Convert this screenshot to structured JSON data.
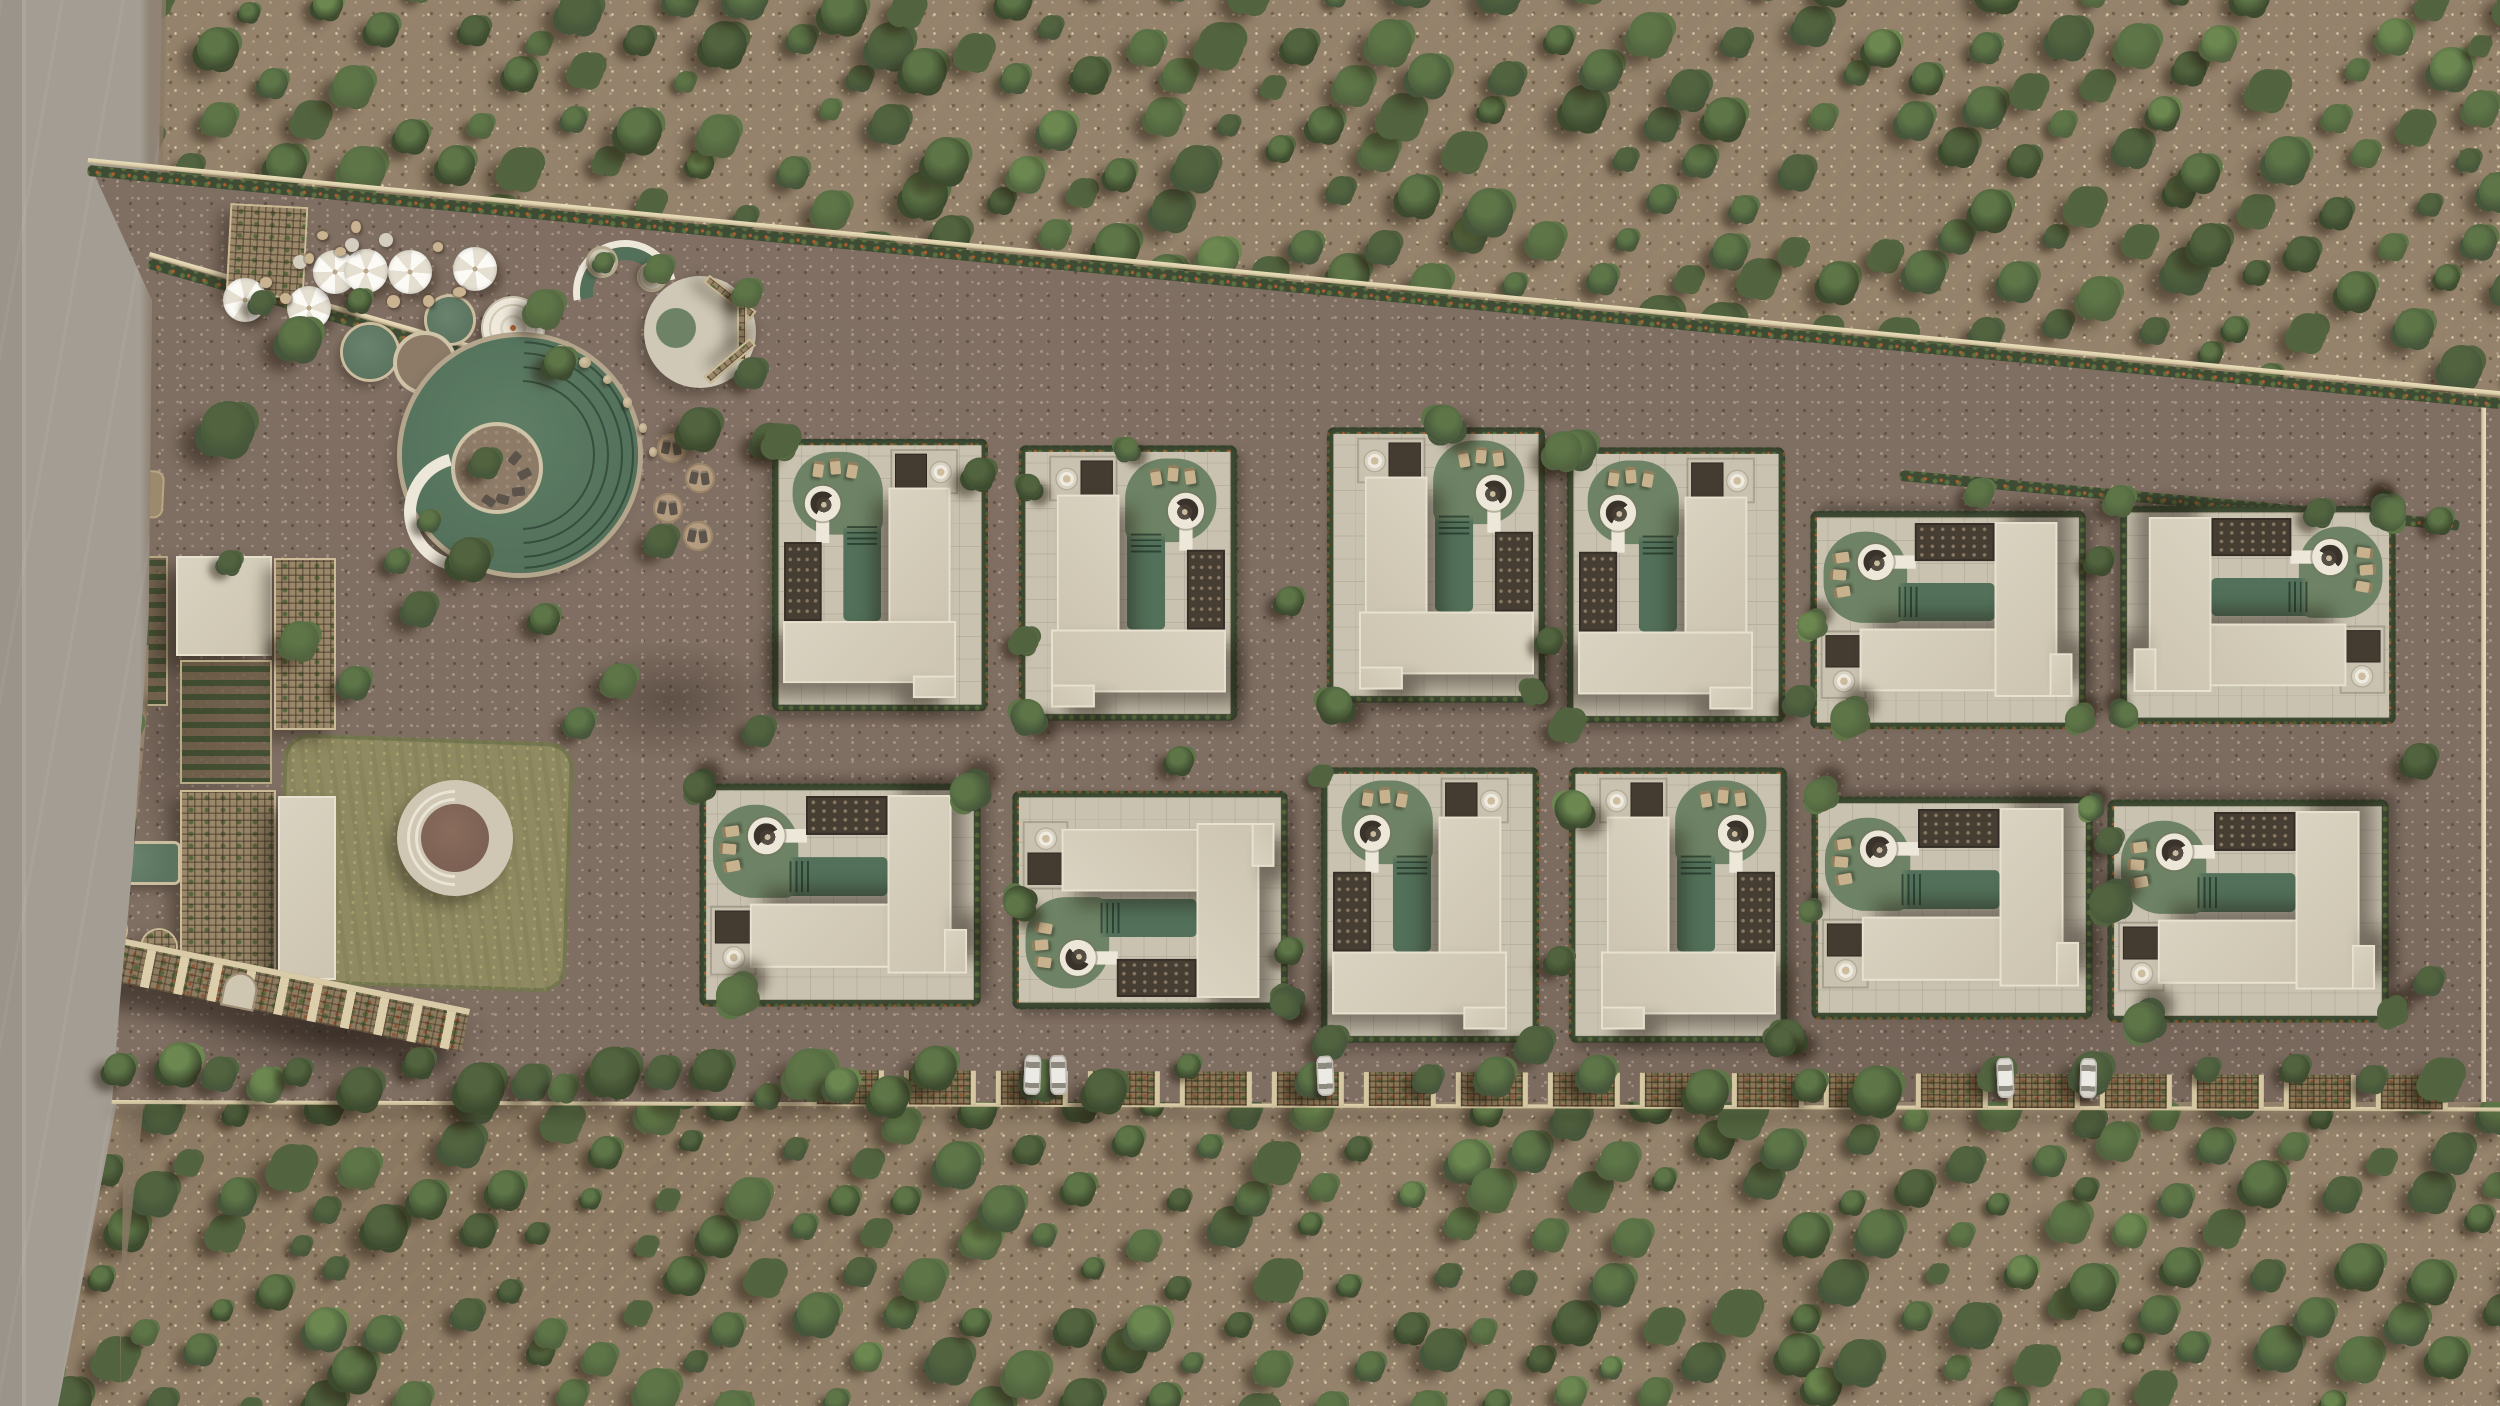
{
  "scene": {
    "type": "architectural-aerial-site-plan",
    "description": "Top-down photorealistic render of a boutique villa resort with amenity gardens set inside an olive grove, access road on the west, parking pergola fence on the south",
    "palette": {
      "road": "#a39d93",
      "roadEdge": "#8b7b66",
      "soil": "#94826c",
      "paving": "#7f6e62",
      "wall": "#dccfab",
      "fence": "#c9ba96",
      "hedge": "#3f4c34",
      "flower": "#b25c2d",
      "villaPave": "#c9c2b0",
      "roof": "#dad3c1",
      "roofEdge": "#e8e1cf",
      "lawn": "#6e8365",
      "pool": "#53715a",
      "deck": "#ece7d9",
      "court": "#473e33",
      "lawnOlive": "#8f8a62",
      "pond": "#5a7460"
    },
    "treePalette": [
      "#3c4a2e",
      "#46563a",
      "#52643f",
      "#5d7547",
      "#6c8850"
    ],
    "grove": {
      "row_angle_deg": -50,
      "row_spacing": 64,
      "tree_spacing": 54,
      "jitter": 14,
      "seed": 7
    },
    "boundary": {
      "north_from": [
        88,
        160
      ],
      "north_to": [
        2500,
        393
      ],
      "south_y": 1102,
      "east_wall_x": 2486
    },
    "villas": {
      "count": 12,
      "rows": 2,
      "instances": [
        {
          "id": "T1",
          "cx": 880,
          "cy": 575,
          "s": 0.94,
          "t": ""
        },
        {
          "id": "T2",
          "cx": 1128,
          "cy": 583,
          "s": 0.95,
          "t": "scaleX(-1)"
        },
        {
          "id": "T3",
          "cx": 1436,
          "cy": 565,
          "s": 0.95,
          "t": "scaleX(-1)"
        },
        {
          "id": "T4",
          "cx": 1676,
          "cy": 585,
          "s": 0.95,
          "t": ""
        },
        {
          "id": "T5",
          "cx": 1948,
          "cy": 620,
          "s": 0.95,
          "t": "rotate(90deg) scaleY(-1)"
        },
        {
          "id": "T6",
          "cx": 2258,
          "cy": 615,
          "s": 0.95,
          "t": "rotate(90deg)"
        },
        {
          "id": "B1",
          "cx": 840,
          "cy": 895,
          "s": 0.97,
          "t": "rotate(90deg) scaleY(-1)"
        },
        {
          "id": "B2",
          "cx": 1150,
          "cy": 900,
          "s": 0.95,
          "t": "rotate(-90deg)"
        },
        {
          "id": "B3",
          "cx": 1430,
          "cy": 905,
          "s": 0.95,
          "t": ""
        },
        {
          "id": "B4",
          "cx": 1678,
          "cy": 905,
          "s": 0.95,
          "t": "scaleX(-1)"
        },
        {
          "id": "B5",
          "cx": 1952,
          "cy": 908,
          "s": 0.97,
          "t": "rotate(90deg) scaleY(-1)"
        },
        {
          "id": "B6",
          "cx": 2248,
          "cy": 911,
          "s": 0.97,
          "t": "rotate(90deg) scaleY(-1)"
        }
      ]
    },
    "fence": {
      "x": 112,
      "y": 1040,
      "w": 2390,
      "bay_step": 92,
      "bays_from": 700,
      "seed": 11
    },
    "cars": [
      {
        "x": 1032
      },
      {
        "x": 1058
      },
      {
        "x": 1325
      },
      {
        "x": 2005
      },
      {
        "x": 2088
      }
    ],
    "umbrellas": [
      [
        245,
        300
      ],
      [
        309,
        308
      ],
      [
        335,
        272
      ],
      [
        366,
        271
      ],
      [
        410,
        272
      ],
      [
        475,
        269
      ]
    ],
    "parasols": [
      [
        352,
        245
      ],
      [
        300,
        262
      ],
      [
        386,
        240
      ]
    ],
    "seats": [
      [
        285,
        298
      ],
      [
        340,
        252
      ],
      [
        392,
        300
      ],
      [
        438,
        247
      ],
      [
        310,
        258
      ],
      [
        356,
        226
      ],
      [
        428,
        300
      ],
      [
        458,
        292
      ],
      [
        265,
        282
      ],
      [
        322,
        236
      ]
    ],
    "loungerPads": [
      [
        672,
        448
      ],
      [
        700,
        478
      ],
      [
        668,
        508
      ],
      [
        698,
        536
      ]
    ],
    "rocks": [
      [
        560,
        350
      ],
      [
        584,
        362
      ],
      [
        608,
        380
      ],
      [
        628,
        402
      ],
      [
        644,
        428
      ],
      [
        654,
        452
      ]
    ],
    "islandLoungers": [
      [
        14,
        -18,
        40
      ],
      [
        24,
        -2,
        62
      ],
      [
        18,
        16,
        84
      ],
      [
        2,
        24,
        104
      ],
      [
        -12,
        26,
        124
      ]
    ],
    "amenityTrees": [
      [
        228,
        428,
        44
      ],
      [
        300,
        338,
        36
      ],
      [
        262,
        302,
        20
      ],
      [
        360,
        300,
        20
      ],
      [
        545,
        308,
        30
      ],
      [
        560,
        362,
        26
      ],
      [
        660,
        268,
        22
      ],
      [
        604,
        262,
        16
      ],
      [
        748,
        292,
        22
      ],
      [
        752,
        372,
        24
      ],
      [
        700,
        428,
        34
      ],
      [
        662,
        540,
        26
      ],
      [
        470,
        558,
        34
      ],
      [
        420,
        608,
        28
      ],
      [
        545,
        618,
        24
      ],
      [
        486,
        462,
        24
      ],
      [
        300,
        640,
        30
      ],
      [
        355,
        682,
        26
      ],
      [
        95,
        302,
        28
      ],
      [
        86,
        382,
        22
      ],
      [
        620,
        680,
        28
      ],
      [
        580,
        722,
        24
      ],
      [
        230,
        562,
        20
      ],
      [
        398,
        560,
        20
      ],
      [
        430,
        520,
        18
      ]
    ],
    "pavingTrees": [
      [
        1290,
        600,
        20
      ],
      [
        1550,
        640,
        18
      ],
      [
        1800,
        700,
        22
      ],
      [
        2100,
        560,
        20
      ],
      [
        1290,
        950,
        18
      ],
      [
        1560,
        960,
        20
      ],
      [
        2110,
        840,
        18
      ],
      [
        1025,
        640,
        20
      ],
      [
        760,
        730,
        22
      ],
      [
        1180,
        760,
        20
      ],
      [
        2420,
        760,
        24
      ],
      [
        2430,
        980,
        20
      ]
    ],
    "hedge2Trees": [
      [
        1980,
        492,
        20
      ],
      [
        2120,
        500,
        22
      ],
      [
        2320,
        512,
        20
      ],
      [
        2440,
        520,
        18
      ]
    ]
  }
}
